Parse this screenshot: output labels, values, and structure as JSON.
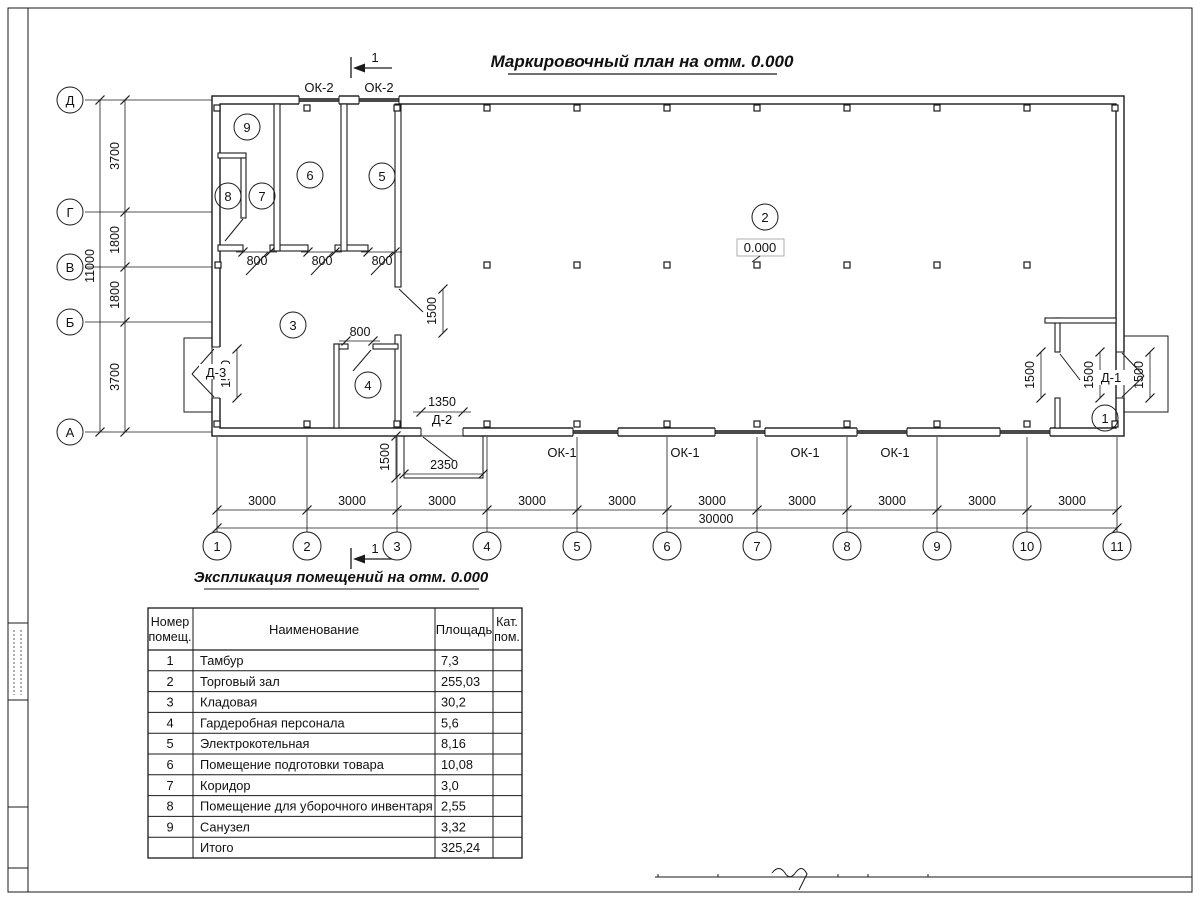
{
  "titles": {
    "plan": "Маркировочный план на отм. 0.000",
    "table": "Экспликация помещений на отм. 0.000"
  },
  "grid": {
    "v_axes": [
      "Д",
      "Г",
      "В",
      "Б",
      "А"
    ],
    "h_axes": [
      "1",
      "2",
      "3",
      "4",
      "5",
      "6",
      "7",
      "8",
      "9",
      "10",
      "11"
    ],
    "v_dims": [
      "3700",
      "1800",
      "1800",
      "3700"
    ],
    "v_total": "11000",
    "h_dims": [
      "3000",
      "3000",
      "3000",
      "3000",
      "3000",
      "3000",
      "3000",
      "3000",
      "3000",
      "3000"
    ],
    "h_total": "30000"
  },
  "marks": {
    "section": "1",
    "elevation": "0.000",
    "windows_top": [
      "ОК-2",
      "ОК-2"
    ],
    "windows_bottom": [
      "ОК-1",
      "ОК-1",
      "ОК-1",
      "ОК-1"
    ],
    "door_d1": "Д-1",
    "door_d2": "Д-2",
    "door_d3": "Д-3",
    "rooms": {
      "r1": "1",
      "r2": "2",
      "r3": "3",
      "r4": "4",
      "r5": "5",
      "r6": "6",
      "r7": "7",
      "r8": "8",
      "r9": "9"
    },
    "dims": {
      "d800": "800",
      "d1350": "1350",
      "d1500": "1500",
      "d2350": "2350"
    }
  },
  "table": {
    "header": {
      "num_l1": "Номер",
      "num_l2": "помещ.",
      "name": "Наименование",
      "area": "Площадь",
      "cat_l1": "Кат.",
      "cat_l2": "пом."
    },
    "rows": [
      {
        "num": "1",
        "name": "Тамбур",
        "area": "7,3"
      },
      {
        "num": "2",
        "name": "Торговый зал",
        "area": "255,03"
      },
      {
        "num": "3",
        "name": "Кладовая",
        "area": "30,2"
      },
      {
        "num": "4",
        "name": "Гардеробная персонала",
        "area": "5,6"
      },
      {
        "num": "5",
        "name": "Электрокотельная",
        "area": "8,16"
      },
      {
        "num": "6",
        "name": "Помещение подготовки товара",
        "area": "10,08"
      },
      {
        "num": "7",
        "name": "Коридор",
        "area": "3,0"
      },
      {
        "num": "8",
        "name": "Помещение для уборочного инвентаря",
        "area": "2,55"
      },
      {
        "num": "9",
        "name": "Санузел",
        "area": "3,32"
      }
    ],
    "total": {
      "label": "Итого",
      "area": "325,24"
    }
  }
}
